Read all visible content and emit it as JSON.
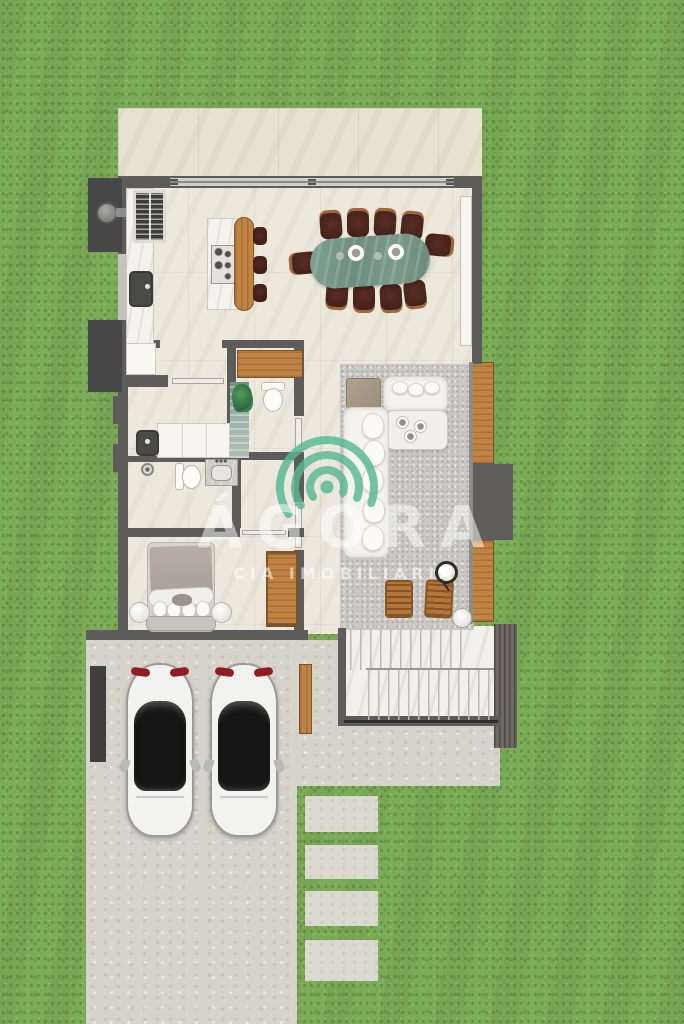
{
  "scene": {
    "type": "residential floor plan, top-down 3D render on lawn",
    "watermark": {
      "brand": "ÁGORA",
      "subtitle": "CIA IMOBILIÁRIA",
      "icon": "signal-arcs-icon",
      "icon_color": "#57b894",
      "text_color": "rgba(255,255,255,0.5)"
    },
    "colors": {
      "grass": "#7cab57",
      "terrace_tile": "#e7e1d2",
      "interior_floor": "#ece8dc",
      "wall": "#5d5c5a",
      "wood": "#c08344",
      "concrete": "#d6d3ca",
      "rug": "#c9c8c4",
      "stairs_marble": "#f2f0ea",
      "dining_table_green": "#78968a",
      "chair_dark": "#4e2720",
      "sofa_white": "#f4f3ef",
      "car_body": "#f2f2f0",
      "car_glass": "#161616",
      "deck_dark": "#6e6a63",
      "utility_dark": "#474747"
    }
  },
  "rooms": {
    "terrace": {
      "features": [
        "tiled slab",
        "sliding glass door"
      ]
    },
    "kitchen": {
      "features": [
        "refrigerator",
        "wall counter with dark sink",
        "island with 5-burner cooktop",
        "wood breakfast bar",
        "3 bar stools"
      ]
    },
    "dining": {
      "features": [
        "green stone oval table",
        "10 dark chairs",
        "2 plates",
        "2 small bowls"
      ]
    },
    "living": {
      "features": [
        "gray area rug",
        "L-shaped white sofa",
        "taupe ottoman",
        "coffee table with cups",
        "2 wood armchairs",
        "round side table",
        "floor lamp"
      ]
    },
    "powder_room": {
      "features": [
        "toilet",
        "glass shower strip",
        "plant",
        "wood cabinet"
      ]
    },
    "laundry": {
      "features": [
        "dark utility tub",
        "white counter with machines"
      ]
    },
    "bathroom": {
      "features": [
        "toilet",
        "stone vanity with faucet",
        "shower head"
      ]
    },
    "bedroom": {
      "features": [
        "double bed with taupe blanket",
        "2 round bedside stools",
        "wood wardrobe"
      ]
    },
    "stairs": {
      "features": [
        "two white marble flights",
        "handrail line"
      ]
    },
    "exterior": {
      "cars": 2,
      "stepping_stones": 4,
      "deck_strips": [
        "upper wood strip",
        "dark unit block",
        "lower wood strip",
        "dark slatted deck"
      ],
      "utility_boxes": 2,
      "gate_pillar": 1,
      "wood_side_gate": 1
    }
  }
}
